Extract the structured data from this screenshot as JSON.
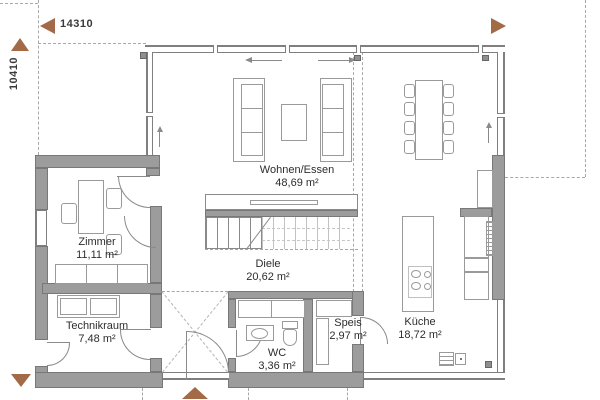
{
  "plan": {
    "dimensions": {
      "width_label": "14310",
      "height_label": "10410"
    },
    "rooms": {
      "wohnen_essen": {
        "name": "Wohnen/Essen",
        "area": "48,69 m²"
      },
      "zimmer": {
        "name": "Zimmer",
        "area": "11,11 m²"
      },
      "technikraum": {
        "name": "Technikraum",
        "area": "7,48 m²"
      },
      "diele": {
        "name": "Diele",
        "area": "20,62 m²"
      },
      "wc": {
        "name": "WC",
        "area": "3,36 m²"
      },
      "speis": {
        "name": "Speis",
        "area": "2,97 m²"
      },
      "kueche": {
        "name": "Küche",
        "area": "18,72 m²"
      }
    },
    "colors": {
      "arrow_brown": "#A26A46",
      "wall_gray": "#9C9C9C",
      "line_gray": "#8A8A8A",
      "text": "#2D2D2D"
    }
  }
}
